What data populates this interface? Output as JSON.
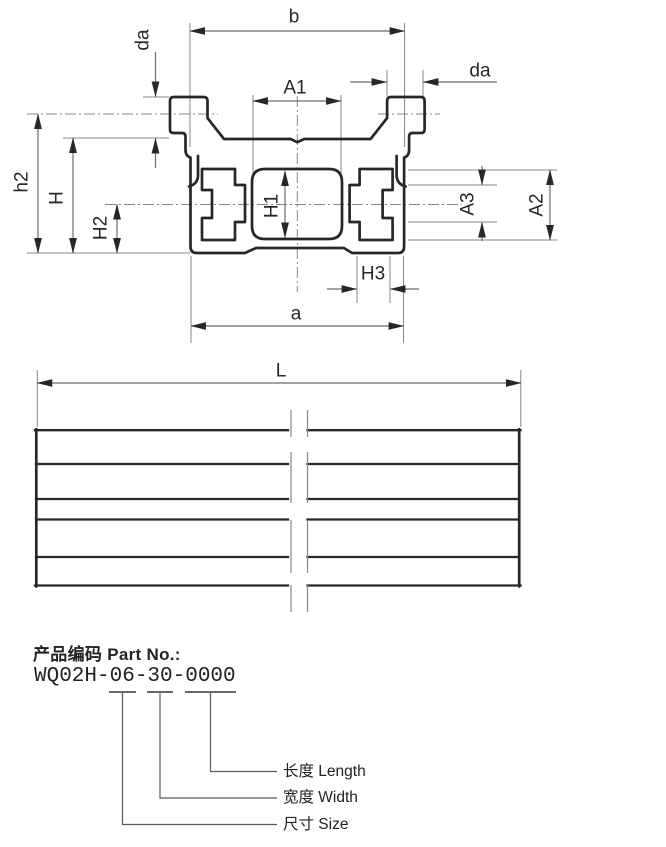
{
  "drawing": {
    "dim_labels": {
      "b": "b",
      "da_left": "da",
      "da_right": "da",
      "A1": "A1",
      "h2": "h2",
      "H": "H",
      "H2": "H2",
      "H1": "H1",
      "A3": "A3",
      "A2": "A2",
      "H3": "H3",
      "a": "a",
      "L": "L"
    }
  },
  "part_info": {
    "title": "产品编码 Part No.:",
    "part_number": "WQ02H-06-30-0000",
    "callouts": [
      {
        "label": "长度 Length"
      },
      {
        "label": "宽度 Width"
      },
      {
        "label": "尺寸 Size"
      }
    ]
  },
  "colors": {
    "ink": "#2b2626",
    "dim_line": "#6e6a6a",
    "background": "#ffffff"
  }
}
